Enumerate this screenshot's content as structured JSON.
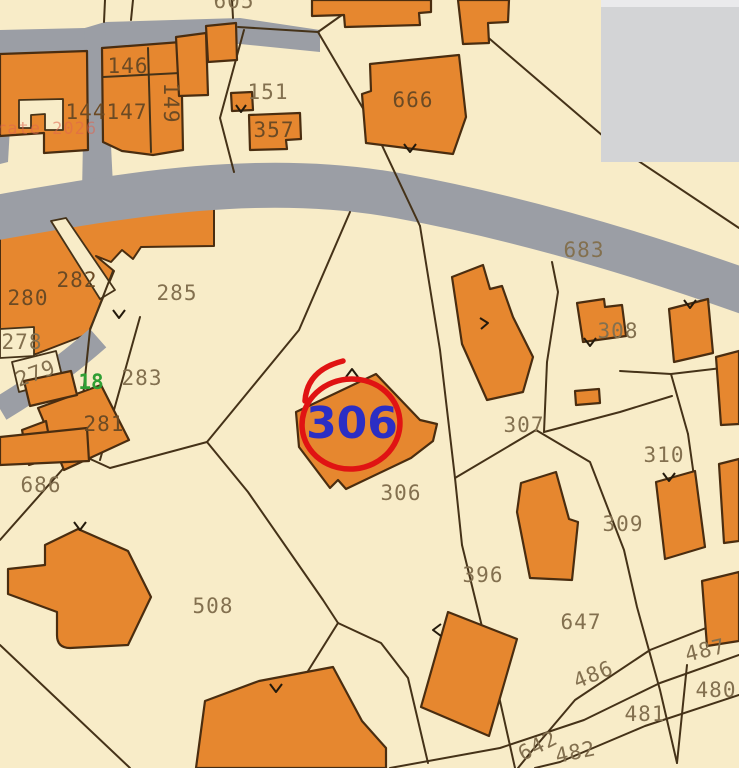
{
  "map": {
    "type": "cadastral-parcel-map",
    "highlighted_parcel": {
      "number": "306",
      "text_color": "#2b2ec4",
      "circle_color": "#e01313"
    },
    "watermark": {
      "text": "rate 2026",
      "color": "#e0654f"
    },
    "road_label": {
      "text": "18",
      "color": "#2f9e33"
    },
    "overlay_panel": {
      "color": "#d3d4d6"
    },
    "colors": {
      "background": "#f8ecc8",
      "building_fill": "#e6872f",
      "building_outline": "#4a2d10",
      "road": "#9b9ea5",
      "boundary_line": "#453218",
      "label_default": "#83704f",
      "label_on_orange": "#6b4a24"
    },
    "parcel_labels": [
      {
        "text": "605",
        "x": 234,
        "y": 8
      },
      {
        "text": "146",
        "x": 128,
        "y": 73,
        "dark": true
      },
      {
        "text": "144",
        "x": 86,
        "y": 119,
        "dark": true
      },
      {
        "text": "147",
        "x": 127,
        "y": 119,
        "dark": true
      },
      {
        "text": "149",
        "x": 164,
        "y": 103,
        "rotate": 90,
        "dark": true
      },
      {
        "text": "151",
        "x": 268,
        "y": 99
      },
      {
        "text": "357",
        "x": 274,
        "y": 137,
        "dark": true
      },
      {
        "text": "666",
        "x": 413,
        "y": 107,
        "dark": true
      },
      {
        "text": "683",
        "x": 584,
        "y": 257
      },
      {
        "text": "282",
        "x": 77,
        "y": 287,
        "dark": true
      },
      {
        "text": "280",
        "x": 28,
        "y": 305,
        "dark": true
      },
      {
        "text": "285",
        "x": 177,
        "y": 300
      },
      {
        "text": "278",
        "x": 22,
        "y": 349
      },
      {
        "text": "279",
        "x": 38,
        "y": 380,
        "rotate": -20
      },
      {
        "text": "283",
        "x": 142,
        "y": 385
      },
      {
        "text": "281",
        "x": 104,
        "y": 431,
        "dark": true
      },
      {
        "text": "308",
        "x": 618,
        "y": 338
      },
      {
        "text": "307",
        "x": 524,
        "y": 432
      },
      {
        "text": "306",
        "x": 401,
        "y": 500
      },
      {
        "text": "310",
        "x": 664,
        "y": 462
      },
      {
        "text": "309",
        "x": 623,
        "y": 531
      },
      {
        "text": "686",
        "x": 41,
        "y": 492
      },
      {
        "text": "508",
        "x": 213,
        "y": 613
      },
      {
        "text": "396",
        "x": 483,
        "y": 582
      },
      {
        "text": "647",
        "x": 581,
        "y": 629
      },
      {
        "text": "486",
        "x": 596,
        "y": 681,
        "rotate": -22
      },
      {
        "text": "487",
        "x": 707,
        "y": 657,
        "rotate": -13
      },
      {
        "text": "480",
        "x": 716,
        "y": 697
      },
      {
        "text": "481",
        "x": 645,
        "y": 721
      },
      {
        "text": "642",
        "x": 541,
        "y": 752,
        "rotate": -27
      },
      {
        "text": "482",
        "x": 577,
        "y": 759,
        "rotate": -12
      }
    ]
  }
}
